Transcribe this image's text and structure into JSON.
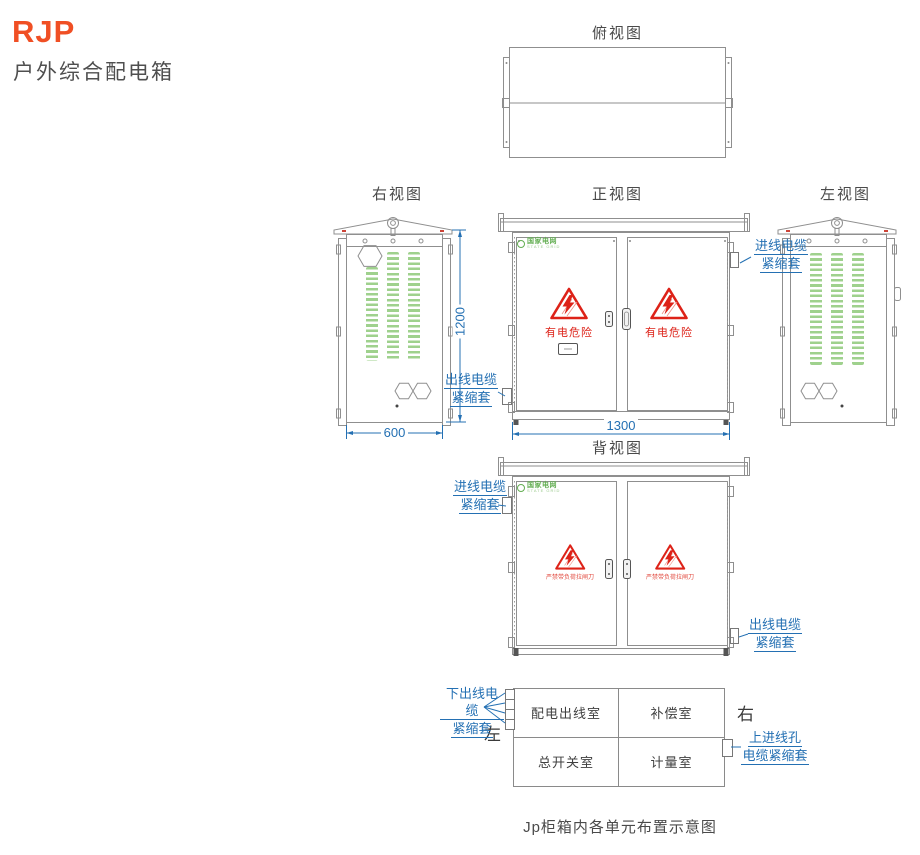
{
  "header": {
    "brand": "RJP",
    "subtitle": "户外综合配电箱"
  },
  "logo": {
    "name": "国家电网",
    "sub": "STATE GRID"
  },
  "views": {
    "top": {
      "title": "俯视图"
    },
    "right": {
      "title": "右视图",
      "dim_width": "600",
      "dim_height": "1200"
    },
    "front": {
      "title": "正视图",
      "dim_width": "1300",
      "warning_text": "有电危险",
      "label_inlet": {
        "line1": "进线电缆",
        "line2": "紧缩套"
      },
      "label_outlet": {
        "line1": "出线电缆",
        "line2": "紧缩套"
      }
    },
    "left": {
      "title": "左视图"
    },
    "back": {
      "title": "背视图",
      "warning_text": "严禁带负荷拉闸刀",
      "label_inlet": {
        "line1": "进线电缆",
        "line2": "紧缩套"
      },
      "label_outlet": {
        "line1": "出线电缆",
        "line2": "紧缩套"
      }
    }
  },
  "layout_diagram": {
    "rows": [
      [
        "配电出线室",
        "补偿室"
      ],
      [
        "总开关室",
        "计量室"
      ]
    ],
    "left_marker": "左",
    "right_marker": "右",
    "label_bottom_outlet": {
      "line1": "下出线电缆",
      "line2": "紧缩套"
    },
    "label_top_inlet": {
      "line1": "上进线孔",
      "line2": "电缆紧缩套"
    },
    "caption": "Jp柜箱内各单元布置示意图"
  },
  "colors": {
    "brand_orange": "#F04F24",
    "label_blue": "#2470B3",
    "warning_red": "#DD2218",
    "louver_green": "#9FD18D",
    "logo_green": "#63AE52",
    "line_gray": "#8F8F8F"
  }
}
